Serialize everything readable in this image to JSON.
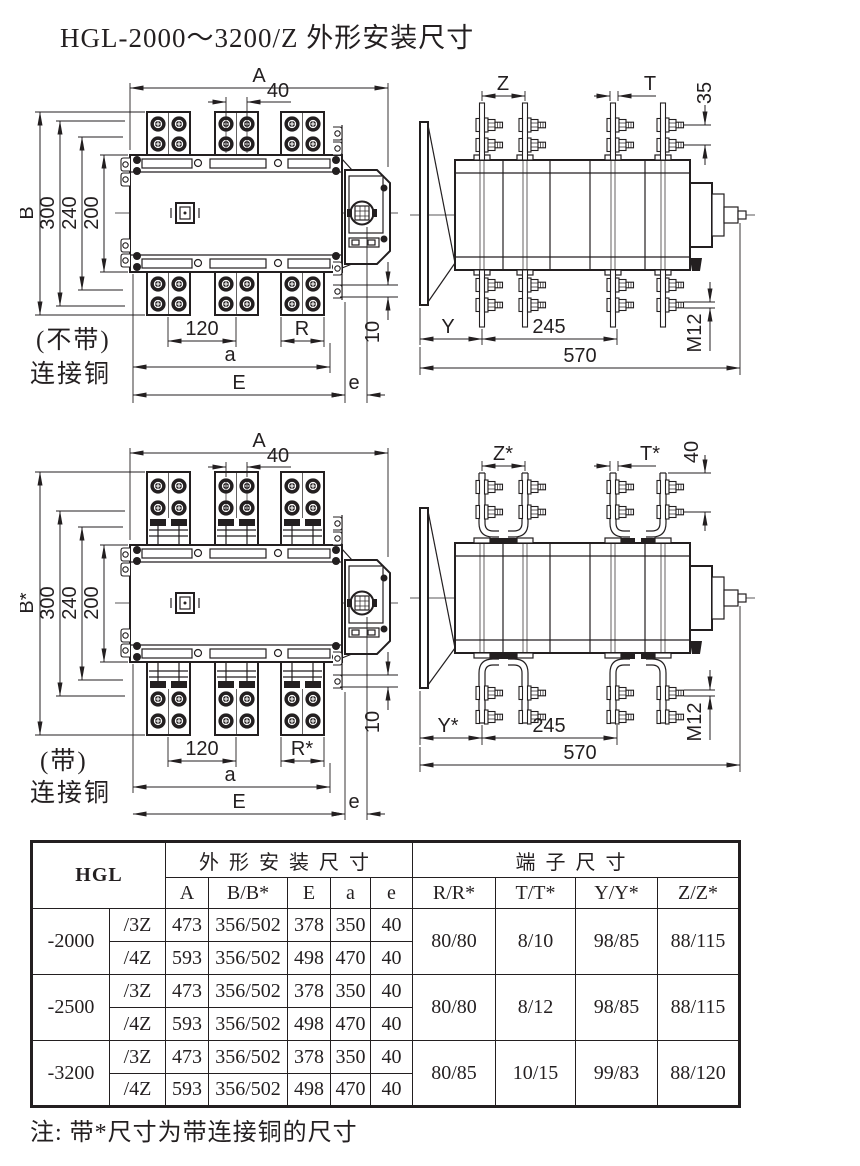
{
  "title": "HGL-2000～3200/Z 外形安装尺寸",
  "note": "注: 带*尺寸为带连接铜的尺寸",
  "colors": {
    "ink": "#231f20",
    "background": "#ffffff"
  },
  "views": {
    "front_plain": {
      "caption": [
        "(不带)",
        "连接铜"
      ],
      "dims": {
        "A": "A",
        "w40": "40",
        "B": "B",
        "h300": "300",
        "h240": "240",
        "h200": "200",
        "p120": "120",
        "R": "R",
        "off10": "10",
        "a": "a",
        "E": "E",
        "e": "e"
      }
    },
    "side_plain": {
      "dims": {
        "Z": "Z",
        "T": "T",
        "v35": "35",
        "Y": "Y",
        "p245": "245",
        "w570": "570",
        "thread": "M12"
      }
    },
    "front_copper": {
      "caption": [
        "(带)",
        "连接铜"
      ],
      "dims": {
        "A": "A",
        "w40": "40",
        "B": "B*",
        "h300": "300",
        "h240": "240",
        "h200": "200",
        "p120": "120",
        "R": "R*",
        "off10": "10",
        "a": "a",
        "E": "E",
        "e": "e"
      }
    },
    "side_copper": {
      "dims": {
        "Z": "Z*",
        "T": "T*",
        "v40": "40",
        "Y": "Y*",
        "p245": "245",
        "w570": "570",
        "thread": "M12"
      }
    }
  },
  "table": {
    "brand": "HGL",
    "sections": {
      "outline": "外形安装尺寸",
      "terminal": "端子尺寸"
    },
    "columns": {
      "A": "A",
      "B": "B/B*",
      "E": "E",
      "a": "a",
      "e": "e",
      "R": "R/R*",
      "T": "T/T*",
      "Y": "Y/Y*",
      "Z": "Z/Z*"
    },
    "groups": [
      {
        "model": "-2000",
        "R": "80/80",
        "T": "8/10",
        "Y": "98/85",
        "Z": "88/115",
        "rows": [
          {
            "variant": "/3Z",
            "A": "473",
            "B": "356/502",
            "E": "378",
            "a": "350",
            "e": "40"
          },
          {
            "variant": "/4Z",
            "A": "593",
            "B": "356/502",
            "E": "498",
            "a": "470",
            "e": "40"
          }
        ]
      },
      {
        "model": "-2500",
        "R": "80/80",
        "T": "8/12",
        "Y": "98/85",
        "Z": "88/115",
        "rows": [
          {
            "variant": "/3Z",
            "A": "473",
            "B": "356/502",
            "E": "378",
            "a": "350",
            "e": "40"
          },
          {
            "variant": "/4Z",
            "A": "593",
            "B": "356/502",
            "E": "498",
            "a": "470",
            "e": "40"
          }
        ]
      },
      {
        "model": "-3200",
        "R": "80/85",
        "T": "10/15",
        "Y": "99/83",
        "Z": "88/120",
        "rows": [
          {
            "variant": "/3Z",
            "A": "473",
            "B": "356/502",
            "E": "378",
            "a": "350",
            "e": "40"
          },
          {
            "variant": "/4Z",
            "A": "593",
            "B": "356/502",
            "E": "498",
            "a": "470",
            "e": "40"
          }
        ]
      }
    ]
  }
}
